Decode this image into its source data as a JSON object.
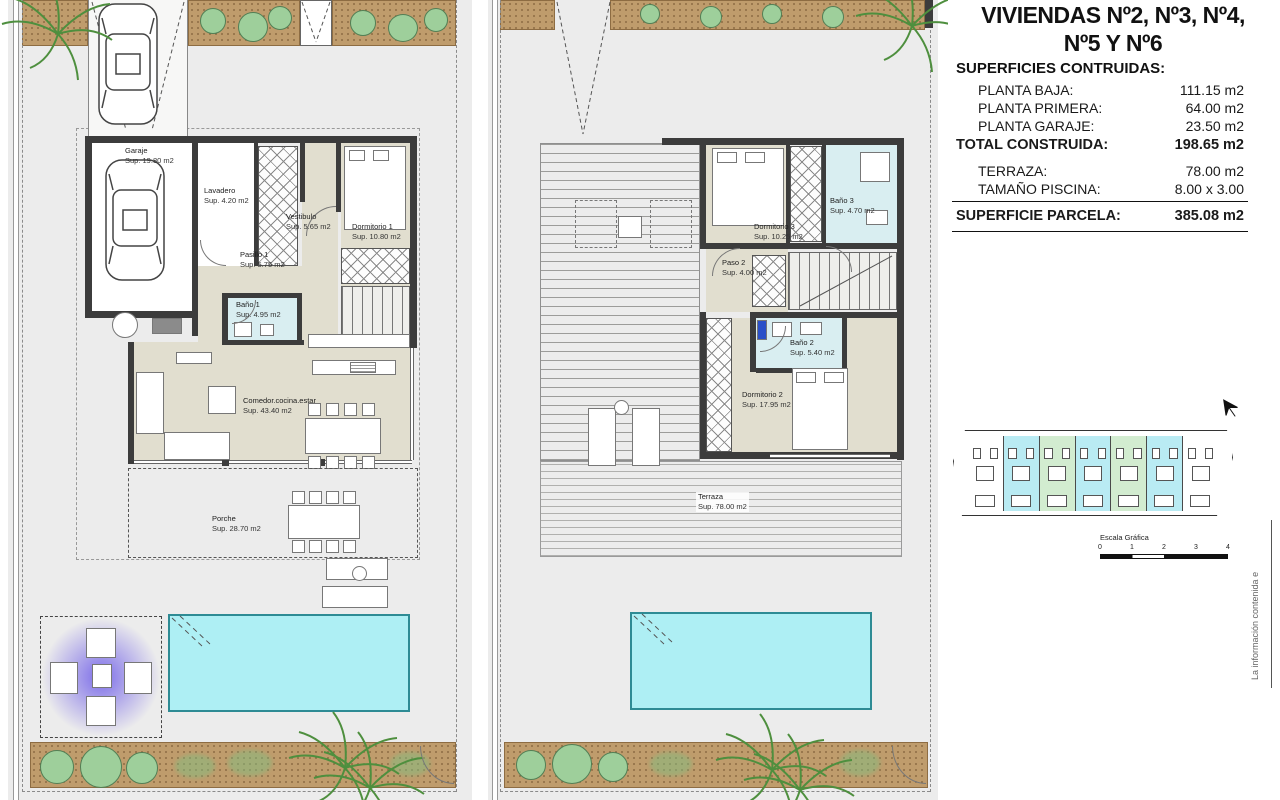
{
  "panel": {
    "title_line1": "VIVIENDAS Nº2, Nº3, Nº4,",
    "title_line2": "Nº5 Y Nº6",
    "surfaces_heading": "SUPERFICIES CONTRUIDAS:",
    "rows": [
      {
        "label": "PLANTA BAJA:",
        "value": "111.15 m2"
      },
      {
        "label": "PLANTA PRIMERA:",
        "value": "64.00 m2"
      },
      {
        "label": "PLANTA GARAJE:",
        "value": "23.50 m2"
      }
    ],
    "total_row": {
      "label": "TOTAL CONSTRUIDA:",
      "value": "198.65 m2"
    },
    "secondary_rows": [
      {
        "label": "TERRAZA:",
        "value": "78.00 m2"
      },
      {
        "label": "TAMAÑO PISCINA:",
        "value": "8.00 x 3.00"
      }
    ],
    "parcela_row": {
      "label": "SUPERFICIE PARCELA:",
      "value": "385.08 m2"
    },
    "scale_bar": {
      "title": "Escala Gráfica",
      "ticks": [
        "0",
        "1",
        "2",
        "3",
        "4"
      ]
    },
    "side_note": "La información contenida e"
  },
  "plan_left": {
    "rooms": [
      {
        "name": "Garaje",
        "sup": "Sup. 19.80 m2"
      },
      {
        "name": "Lavadero",
        "sup": "Sup. 4.20 m2"
      },
      {
        "name": "Vestibulo",
        "sup": "Sup. 5.65 m2"
      },
      {
        "name": "Dormitorio 1",
        "sup": "Sup. 10.80 m2"
      },
      {
        "name": "Pasillo 1",
        "sup": "Sup. 5.75 m2"
      },
      {
        "name": "Baño 1",
        "sup": "Sup. 4.95 m2"
      },
      {
        "name": "Comedor.cocina.estar",
        "sup": "Sup. 43.40 m2"
      },
      {
        "name": "Porche",
        "sup": "Sup. 28.70 m2"
      }
    ]
  },
  "plan_right": {
    "rooms": [
      {
        "name": "Dormitorio 3",
        "sup": "Sup. 10.25 m2"
      },
      {
        "name": "Baño 3",
        "sup": "Sup. 4.70 m2"
      },
      {
        "name": "Paso 2",
        "sup": "Sup. 4.00 m2"
      },
      {
        "name": "Baño 2",
        "sup": "Sup. 5.40 m2"
      },
      {
        "name": "Dormitorio 2",
        "sup": "Sup. 17.95 m2"
      },
      {
        "name": "Terraza",
        "sup": "Sup. 78.00 m2"
      }
    ]
  },
  "site_plan": {
    "unit_styles": [
      "background:#ffffff",
      "background:#b9ebf3",
      "background:#d2ecd0",
      "background:#b9ebf3",
      "background:#d2ecd0",
      "background:#b9ebf3",
      "background:#ffffff"
    ]
  },
  "colors": {
    "wall": "#3c3c3c",
    "floor_beige": "#e1decf",
    "bathroom_cyan": "#d9eef1",
    "pool": "#aeeff4",
    "sand": "#bf9c6c",
    "unit_highlight_cyan": "#b9ebf3",
    "unit_highlight_green": "#d2ecd0"
  }
}
